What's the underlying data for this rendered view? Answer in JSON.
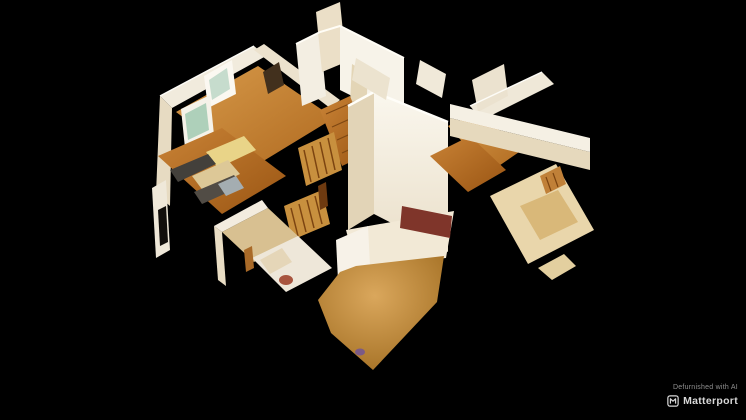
{
  "viewer": {
    "background_color": "#000000",
    "scene": {
      "type": "dollhouse-3d-model",
      "description": "Overhead cutaway dollhouse view of a defurnished house interior: white cut walls, hardwood floors, kitchen with dark counters and stainless appliance at left, central staircase with wood balusters, bathroom with toilet at lower left, large tan carpeted room at bottom center, hallway and bedrooms with pale floors at right, all floating on a black background",
      "palette": {
        "wall_bright": "#f8f4ea",
        "wall_cream": "#ecdfc6",
        "wall_shadow": "#d8c29a",
        "floor_wood_light": "#d79a4a",
        "floor_wood_dark": "#9a5513",
        "floor_carpet": "#c98f3e",
        "railing_wood": "#c8903e",
        "counter_dark": "#43403b",
        "window_glass": "#aed0ba",
        "accent_maroon": "#7f352a"
      }
    }
  },
  "watermark": {
    "line1": "Defurnished with AI",
    "brand": "Matterport",
    "line1_color": "#909090",
    "brand_color": "#d9d9d9"
  }
}
